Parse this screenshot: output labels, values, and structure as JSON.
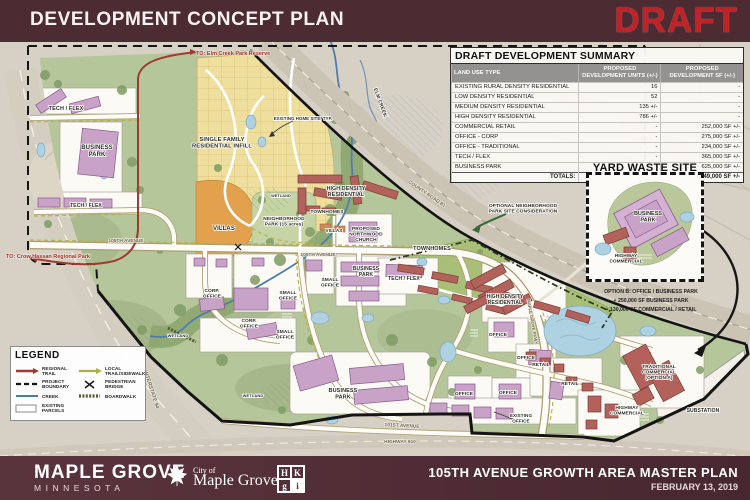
{
  "header": {
    "title": "DEVELOPMENT CONCEPT PLAN",
    "draft_stamp": "DRAFT"
  },
  "summary_table": {
    "title": "DRAFT DEVELOPMENT SUMMARY",
    "columns": [
      "LAND USE TYPE",
      "PROPOSED DEVELOPMENT UNITS (+/-)",
      "PROPOSED DEVELOPMENT SF (+/-)"
    ],
    "rows": [
      {
        "type": "EXISTING RURAL DENSITY RESIDENTIAL",
        "units": "16",
        "sf": "-"
      },
      {
        "type": "LOW DENSITY RESIDENTIAL",
        "units": "52",
        "sf": "-"
      },
      {
        "type": "MEDIUM DENSITY RESIDENTIAL",
        "units": "135 +/-",
        "sf": "-"
      },
      {
        "type": "HIGH DENSITY RESIDENTIAL",
        "units": "786 +/-",
        "sf": "-"
      },
      {
        "type": "COMMERCIAL RETAIL",
        "units": "-",
        "sf": "252,000 SF +/-"
      },
      {
        "type": "OFFICE - CORP",
        "units": "-",
        "sf": "275,000 SF +/-"
      },
      {
        "type": "OFFICE - TRADITIONAL",
        "units": "-",
        "sf": "234,000 SF +/-"
      },
      {
        "type": "TECH / FLEX",
        "units": "-",
        "sf": "365,000 SF +/-"
      },
      {
        "type": "BUSINESS PARK",
        "units": "-",
        "sf": "625,000 SF +/-"
      }
    ],
    "totals": {
      "label": "TOTALS:",
      "units": "989 +/-",
      "sf": "1,749,000 SF +/-"
    }
  },
  "yard_waste": {
    "title": "YARD WASTE SITE",
    "option_lines": [
      "OPTION B: OFFICE / BUSINESS PARK",
      "+ 250,000 SF BUSINESS PARK",
      "+ 130,000 SF COMMERCIAL / RETAIL"
    ]
  },
  "legend": {
    "title": "LEGEND",
    "items": [
      {
        "label": "REGIONAL TRAIL"
      },
      {
        "label": "PROJECT BOUNDARY"
      },
      {
        "label": "CREEK"
      },
      {
        "label": "EXISTING PARCELS"
      },
      {
        "label": "LOCAL TRAIL/SIDEWALK"
      },
      {
        "label": "PEDESTRIAN BRIDGE"
      },
      {
        "label": "BOARDWALK"
      }
    ]
  },
  "map": {
    "labels": {
      "to_elm_creek": "TO: Elm Creek Park Reserve",
      "to_crow_hassan": "TO: Crow Hassan Regional Park",
      "tech_flex": "TECH / FLEX",
      "business_park": "BUSINESS\nPARK",
      "single_family": "SINGLE FAMILY\nRESIDENTIAL INFILL",
      "existing_home": "EXISTING HOME SITE, TYP.",
      "elm_creek": "ELM CREEK",
      "villas": "VILLAS",
      "neighborhood_park": "NEIGHBORHOOD\nPARK (15 acres)",
      "wetland": "WETLAND",
      "high_density": "HIGH DENSITY\nRESIDENTIAL",
      "townhomes": "TOWNHOMES",
      "church": "PROPOSED\nNORTHWOOD\nCHURCH",
      "county_road": "COUNTY ROAD 81",
      "optional_park": "OPTIONAL NEIGHBORHOOD\nPARK SITE CONSIDERATION",
      "ave_105": "105TH AVENUE",
      "ave_101": "101ST AVENUE",
      "hwy_610": "HIGHWAY 610",
      "interstate": "INTERSTATE 94",
      "small_office": "SMALL\nOFFICE",
      "corp_office": "CORP.\nOFFICE",
      "office": "OFFICE",
      "retail": "RETAIL",
      "existing_office": "EXISTING\nOFFICE",
      "mg_pkwy": "MAPLE GROVE PKWY",
      "trad_comm": "TRADITIONAL\nCOMMERCIAL\n(OPTION A)",
      "hwy_comm": "HIGHWAY\nCOMMERCIAL",
      "substation": "SUBSTATION"
    }
  },
  "footer": {
    "city": "MAPLE GROVE",
    "state": "MINNESOTA",
    "logo_city_of": "City of",
    "logo_city_name": "Maple Grove",
    "hkgi_letters": [
      "H",
      "K",
      "g",
      "i"
    ],
    "plan_title": "105TH AVENUE GROWTH AREA MASTER PLAN",
    "date": "FEBRUARY 13, 2019"
  },
  "colors": {
    "brand_maroon": "#4d2b32",
    "draft_red": "#bf2328",
    "map_green": "#b6c69b",
    "parcel_yellow": "#efdf9e",
    "villas_orange": "#e3a14e",
    "water_blue": "#aed2e2",
    "building_purple": "#c9a2c8",
    "building_red": "#b2625b",
    "trail_red": "#a03b2f",
    "trail_olive": "#b8b351"
  }
}
